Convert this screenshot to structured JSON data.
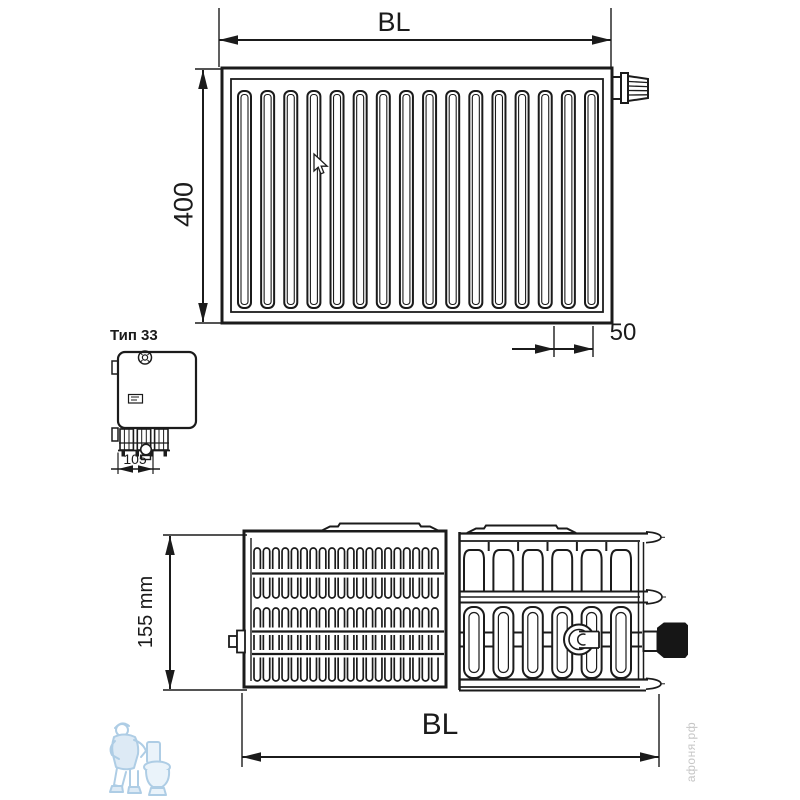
{
  "front_view": {
    "width_label": "BL",
    "height_label": "400",
    "pipe_spacing_label": "50"
  },
  "side_view": {
    "type_label": "Тип 33",
    "depth_label": "105"
  },
  "top_view": {
    "depth_label": "155 mm",
    "width_label": "BL"
  },
  "watermark": {
    "site": "афоня.рф",
    "logo": "plumber-with-toilet"
  },
  "colors": {
    "line": "#1b1b1b",
    "watermark_text": "#c6c6c6",
    "watermark_logo_blue": "#aecde5",
    "fitting_cap_dark": "#161616"
  },
  "drawing": {
    "front_channels": 16,
    "grille_slots_per_band": 20,
    "fin_arch_count": 6,
    "fin_column_count": 6
  }
}
